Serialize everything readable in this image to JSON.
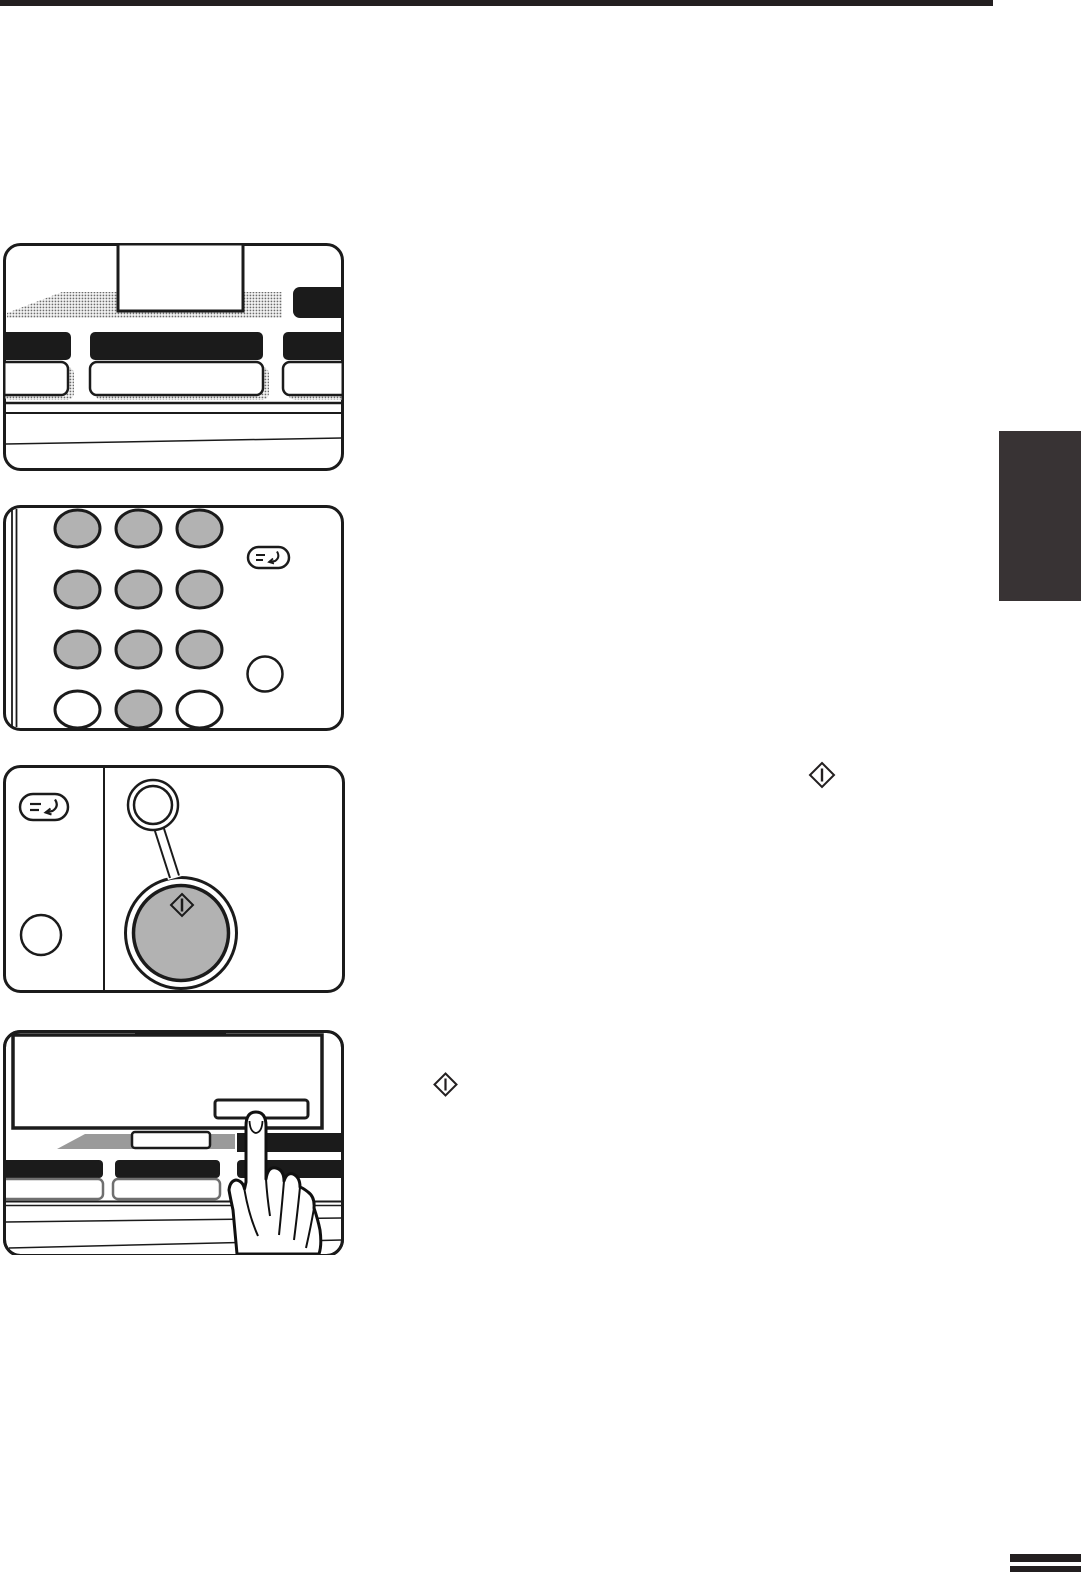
{
  "page": {
    "kind": "scanned copier operation-manual page, illustrations only, no printed text visible",
    "background": "#ffffff"
  },
  "colors": {
    "white": "#ffffff",
    "ink": "#1b1b1b",
    "near_black": "#231f20",
    "tab_dark": "#383334",
    "key_gray": "#b2b2b2",
    "panel_gray": "#9a9a9a"
  },
  "decorations": {
    "top_rule": "black horizontal rule across top of page",
    "chapter_tab": "dark chapter thumb-tab on right page edge",
    "footer_bars": "two short black bars at bottom-right page corner"
  },
  "figures": [
    {
      "name": "figure-operation-panel",
      "description": "Copier operation panel: raised display, halftone panel surface, black key bars and white key buttons"
    },
    {
      "name": "figure-numeric-keypad",
      "description": "10-key numeric keypad; digit keys 1-9 and 0 shown pressed (gray), star and pound keys white; program key and clear key at right",
      "keypad": {
        "rows": 4,
        "cols": 3,
        "gray_key_count": 10,
        "white_key_count": 2
      }
    },
    {
      "name": "figure-start-key",
      "description": "Start key section: program key, clear key, start indicator lamp with callout stem to the round gray start key bearing the diamond start symbol"
    },
    {
      "name": "figure-touch-panel",
      "description": "Touch panel display with a hand pressing a touch key at the lower right of the screen"
    }
  ],
  "inline_icons": [
    {
      "name": "start-key-icon-1",
      "shape": "diamond outline with vertical bar"
    },
    {
      "name": "start-key-icon-2",
      "shape": "diamond outline with vertical bar"
    }
  ]
}
